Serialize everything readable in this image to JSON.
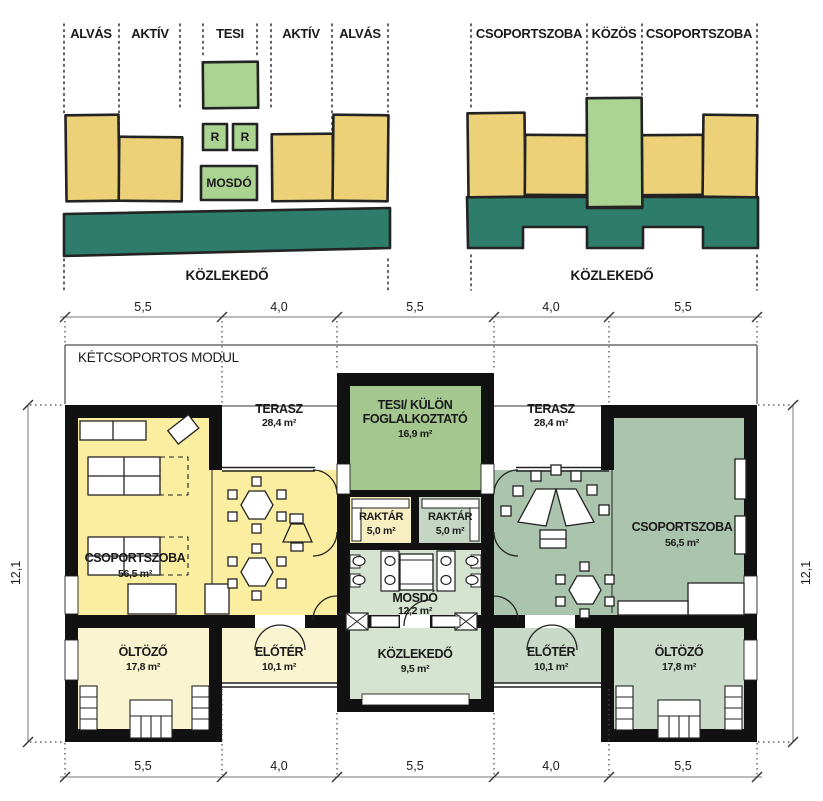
{
  "colors": {
    "outline": "#222222",
    "concept_yellow": "#ecd178",
    "concept_green": "#abd392",
    "concept_teal": "#2e7d6b",
    "plan_yellow": "#fceea0",
    "plan_pale_yellow": "#fbf4d0",
    "plan_raktar_yellow": "#f7eec2",
    "plan_tesi_green": "#a3c78f",
    "plan_sage": "#abc4ae",
    "plan_light_sage": "#c9dac9",
    "plan_pale_green": "#d6e3d1",
    "wall_black": "#111111"
  },
  "concept_left": {
    "zone_labels": [
      "ALVÁS",
      "AKTÍV",
      "TESI",
      "AKTÍV",
      "ALVÁS"
    ],
    "r1": "R",
    "r2": "R",
    "mosdo": "MOSDÓ",
    "korridor": "KÖZLEKEDŐ"
  },
  "concept_right": {
    "zone_labels": [
      "CSOPORTSZOBA",
      "KÖZÖS",
      "CSOPORTSZOBA"
    ],
    "korridor": "KÖZLEKEDŐ"
  },
  "plan": {
    "title": "KÉTCSOPORTOS MODUL",
    "dim_top": [
      "5,5",
      "4,0",
      "5,5",
      "4,0",
      "5,5"
    ],
    "dim_bottom": [
      "5,5",
      "4,0",
      "5,5",
      "4,0",
      "5,5"
    ],
    "dim_left": "12,1",
    "dim_right": "12,1",
    "rooms": {
      "terasz_left": {
        "name": "TERASZ",
        "area": "28,4 m²"
      },
      "tesi": {
        "name_line1": "TESI/ KÜLÖN",
        "name_line2": "FOGLALKOZTATÓ",
        "area": "16,9 m²"
      },
      "terasz_right": {
        "name": "TERASZ",
        "area": "28,4 m²"
      },
      "raktar_left": {
        "name": "RAKTÁR",
        "area": "5,0 m²"
      },
      "raktar_right": {
        "name": "RAKTÁR",
        "area": "5,0 m²"
      },
      "csoportszoba_left": {
        "name": "CSOPORTSZOBA",
        "area": "56,5 m²"
      },
      "csoportszoba_right": {
        "name": "CSOPORTSZOBA",
        "area": "56,5 m²"
      },
      "mosdo": {
        "name": "MOSDÓ",
        "area": "12,2 m²"
      },
      "kozlekedo": {
        "name": "KÖZLEKEDŐ",
        "area": "9,5 m²"
      },
      "oltozo_left": {
        "name": "ÖLTÖZŐ",
        "area": "17,8 m²"
      },
      "eloter_left": {
        "name": "ELŐTÉR",
        "area": "10,1 m²"
      },
      "eloter_right": {
        "name": "ELŐTÉR",
        "area": "10,1 m²"
      },
      "oltozo_right": {
        "name": "ÖLTÖZŐ",
        "area": "17,8 m²"
      }
    }
  }
}
